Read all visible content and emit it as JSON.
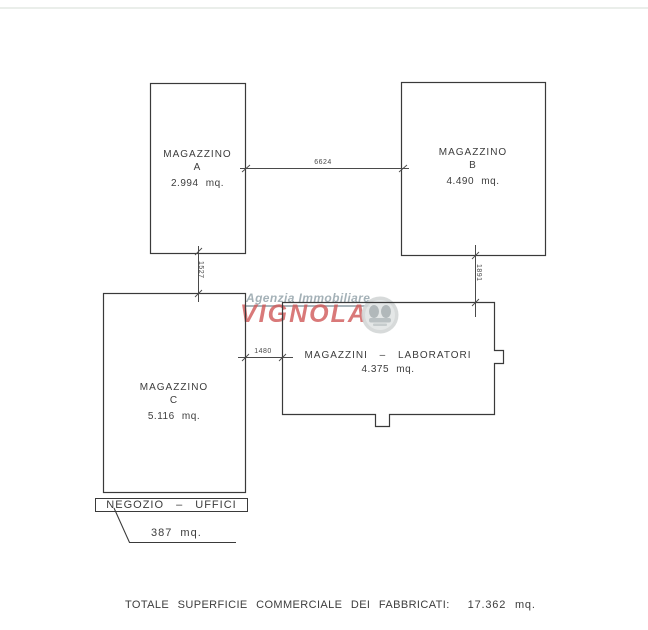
{
  "plan": {
    "buildings": {
      "a": {
        "line1": "MAGAZZINO",
        "line2": "A",
        "area": "2.994 mq."
      },
      "b": {
        "line1": "MAGAZZINO",
        "line2": "B",
        "area": "4.490 mq."
      },
      "c": {
        "line1": "MAGAZZINO",
        "line2": "C",
        "area": "5.116 mq."
      },
      "lab": {
        "line1": "MAGAZZINI – LABORATORI",
        "area": "4.375 mq."
      }
    },
    "dimensions": {
      "ab_span": "6624",
      "a_c_gap": "1527",
      "b_lab_gap": "1891",
      "c_lab_gap": "1480"
    },
    "shop": {
      "label": "NEGOZIO – UFFICI",
      "area": "387 mq."
    },
    "total": {
      "label": "TOTALE SUPERFICIE COMMERCIALE DEI FABBRICATI:",
      "value": "17.362 mq."
    }
  },
  "watermark": {
    "agency": "Agenzia Immobiliare",
    "brand": "VIGNOLA",
    "agency_color": "#95a4ab",
    "brand_color": "#d05858",
    "logo": "heraldic-seal"
  }
}
